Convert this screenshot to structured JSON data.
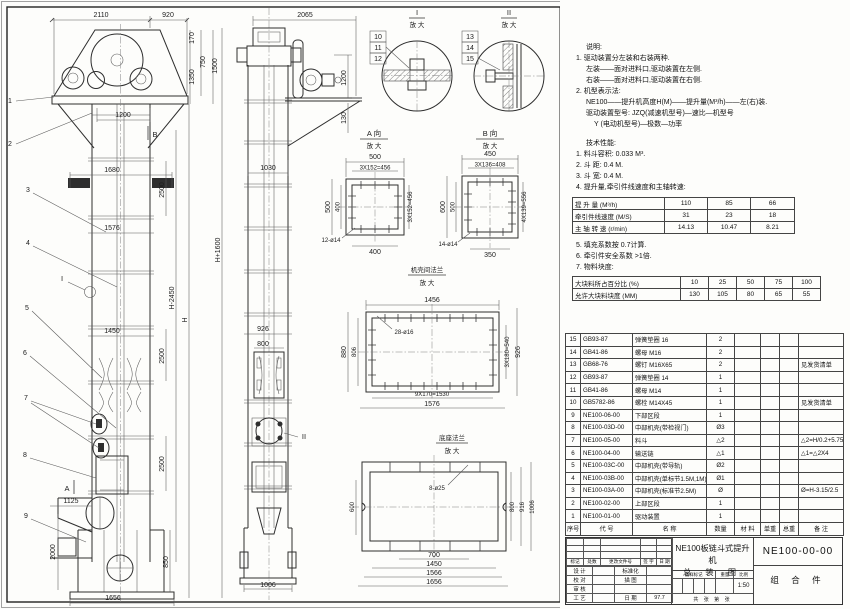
{
  "colors": {
    "line": "#2e2e2e",
    "dim": "#333333",
    "bg": "#fdfdfb"
  },
  "drawing": {
    "front": {
      "dim_top_left": "2110",
      "dim_top_right": "920",
      "dim_170": "170",
      "dim_750": "750",
      "dim_1350": "1350",
      "dim_1500": "1500",
      "dim_1200": "1200",
      "dim_1680": "1680",
      "dim_sec1": "2500",
      "dim_1576": "1576",
      "dim_h_minus": "H-2450",
      "dim_h": "H",
      "dim_h_plus": "H+1600",
      "dim_1450": "1450",
      "dim_sec2": "2500",
      "dim_sec3": "2500",
      "dim_850": "850",
      "dim_1125": "1125",
      "dim_2000": "2000",
      "dim_1656": "1656",
      "leaders": [
        "1",
        "2",
        "3",
        "4",
        "5",
        "6",
        "7",
        "8",
        "9"
      ],
      "marker_b": "B",
      "marker_a": "A",
      "marker_i": "I"
    },
    "side": {
      "dim_2065": "2065",
      "dim_1200": "1200",
      "dim_130": "130",
      "dim_1030": "1030",
      "dim_926": "926",
      "dim_800": "800",
      "dim_1006": "1006",
      "marker_ii": "II"
    },
    "details": {
      "d1_num": "I",
      "d2_num": "II",
      "scale": "放 大",
      "d1_leaders": [
        "10",
        "11",
        "12"
      ],
      "d2_leaders": [
        "13",
        "14",
        "15"
      ]
    },
    "viewA": {
      "title": "A 向",
      "scale": "放 大",
      "dim_top": "500",
      "dim_top2": "3X152=456",
      "dim_left": "500",
      "dim_left2": "400",
      "dim_right": "3X152=456",
      "dim_bottom": "400",
      "dim_holes": "12-ø14"
    },
    "viewB": {
      "title": "B 向",
      "scale": "放 大",
      "dim_top": "450",
      "dim_top2": "3X136=408",
      "dim_left": "600",
      "dim_left2": "500",
      "dim_right": "4X139=556",
      "dim_bottom": "350",
      "dim_holes": "14-ø14"
    },
    "flange": {
      "title": "机壳间法兰",
      "scale": "放 大",
      "dim_top": "1456",
      "dim_holes": "28-ø16",
      "dim_left": "880",
      "dim_left2": "806",
      "dim_right": "3X180=540",
      "dim_right2": "926",
      "dim_bottom": "9X170=1530",
      "dim_bottom2": "1576"
    },
    "base": {
      "title": "底座法兰",
      "scale": "放 大",
      "dim_holes": "8-ø25",
      "dim_left": "600",
      "dim_right1": "800",
      "dim_right2": "916",
      "dim_right3": "1006",
      "dim_bottom1": "700",
      "dim_bottom2": "1450",
      "dim_bottom3": "1566",
      "dim_bottom4": "1656"
    }
  },
  "notes": {
    "heading": "说明:",
    "n1": "1. 驱动装置分左装和右装两种.",
    "n1a": "左装——面对进料口,驱动装置在左侧.",
    "n1b": "右装——面对进料口,驱动装置在右侧.",
    "n2": "2. 机型表示法:",
    "n2a": "NE100——提升机高度H(M)——提升量(M³/h)——左(右)装.",
    "n2b": "驱动装置型号: JZQ(减速机型号)—速比—机型号",
    "n2c": "Y (电动机型号)—极数—功率",
    "tech_heading": "技术性能:",
    "t1": "1. 料斗容积: 0.033 M³.",
    "t2": "2. 斗  距: 0.4 M.",
    "t3": "3. 斗  宽: 0.4 M.",
    "t4": "4. 提升量,牵引件线速度和主轴转速:",
    "t5": "5. 填充系数按 0.7计算.",
    "t6": "6. 牵引件安全系数 >1倍.",
    "t7": "7. 物料块度:"
  },
  "perf": {
    "rows": [
      [
        "提 升 量  (M³/h)",
        "110",
        "85",
        "66"
      ],
      [
        "牵引件线速度 (M/S)",
        "31",
        "23",
        "18"
      ],
      [
        "主 轴 转 速 (r/min)",
        "14.13",
        "10.47",
        "8.21"
      ]
    ]
  },
  "blocks": {
    "rows": [
      [
        "大块料所占百分比 (%)",
        "10",
        "25",
        "50",
        "75",
        "100"
      ],
      [
        "允许大块料块度 (MM)",
        "130",
        "105",
        "80",
        "65",
        "55"
      ]
    ]
  },
  "parts": {
    "headers": [
      "序号",
      "代  号",
      "名    称",
      "数量",
      "材  料",
      "单重",
      "总重",
      "备  注"
    ],
    "rows": [
      [
        "15",
        "GB93-87",
        "弹簧垫圈 16",
        "2",
        "",
        "",
        "",
        ""
      ],
      [
        "14",
        "GB41-86",
        "螺母 M16",
        "2",
        "",
        "",
        "",
        ""
      ],
      [
        "13",
        "GB68-76",
        "螺钉 M16X65",
        "2",
        "",
        "",
        "",
        "见发货清单"
      ],
      [
        "12",
        "GB93-87",
        "弹簧垫圈 14",
        "1",
        "",
        "",
        "",
        ""
      ],
      [
        "11",
        "GB41-86",
        "螺母 M14",
        "1",
        "",
        "",
        "",
        ""
      ],
      [
        "10",
        "GB5782-86",
        "螺栓 M14X45",
        "1",
        "",
        "",
        "",
        "见发货清单"
      ],
      [
        "9",
        "NE100-06-00",
        "下部区段",
        "1",
        "",
        "",
        "",
        ""
      ],
      [
        "8",
        "NE100-03D-00",
        "中部机壳(带检视门)",
        "Ø3",
        "",
        "",
        "",
        ""
      ],
      [
        "7",
        "NE100-05-00",
        "料斗",
        "△2",
        "",
        "",
        "",
        "△2=H/0.2+5.75"
      ],
      [
        "6",
        "NE100-04-00",
        "输送链",
        "△1",
        "",
        "",
        "",
        "△1=△2X4"
      ],
      [
        "5",
        "NE100-03C-00",
        "中部机壳(带导轨)",
        "Ø2",
        "",
        "",
        "",
        ""
      ],
      [
        "4",
        "NE100-03B-00",
        "中部机壳(单标节1.5M,1M)",
        "Ø1",
        "",
        "",
        "",
        ""
      ],
      [
        "3",
        "NE100-03A-00",
        "中部机壳(标准节2.5M)",
        "Ø",
        "",
        "",
        "",
        "Ø=H-3.15/2.5"
      ],
      [
        "2",
        "NE100-02-00",
        "上部区段",
        "1",
        "",
        "",
        "",
        ""
      ],
      [
        "1",
        "NE100-01-00",
        "驱动装置",
        "1",
        "",
        "",
        "",
        ""
      ]
    ]
  },
  "title_block": {
    "title_line1": "NE100板链斗式提升机",
    "title_line2": "总 装 图",
    "drawing_no": "NE100-00-00",
    "part_type": "组 合 件",
    "rev_headers": [
      "标记",
      "处数",
      "更改文件号",
      "签 字",
      "日 期"
    ],
    "sig_rows": [
      [
        "设 计",
        "",
        "标准化",
        ""
      ],
      [
        "校 对",
        "",
        "描 图",
        ""
      ],
      [
        "审 核",
        "",
        "",
        ""
      ],
      [
        "工 艺",
        "",
        "日 期",
        "97.7"
      ]
    ],
    "stamp_headers": [
      "图样标记",
      "重量",
      "比例"
    ],
    "scale_value": "1:50",
    "sheet_info": "共  张  第  张"
  }
}
